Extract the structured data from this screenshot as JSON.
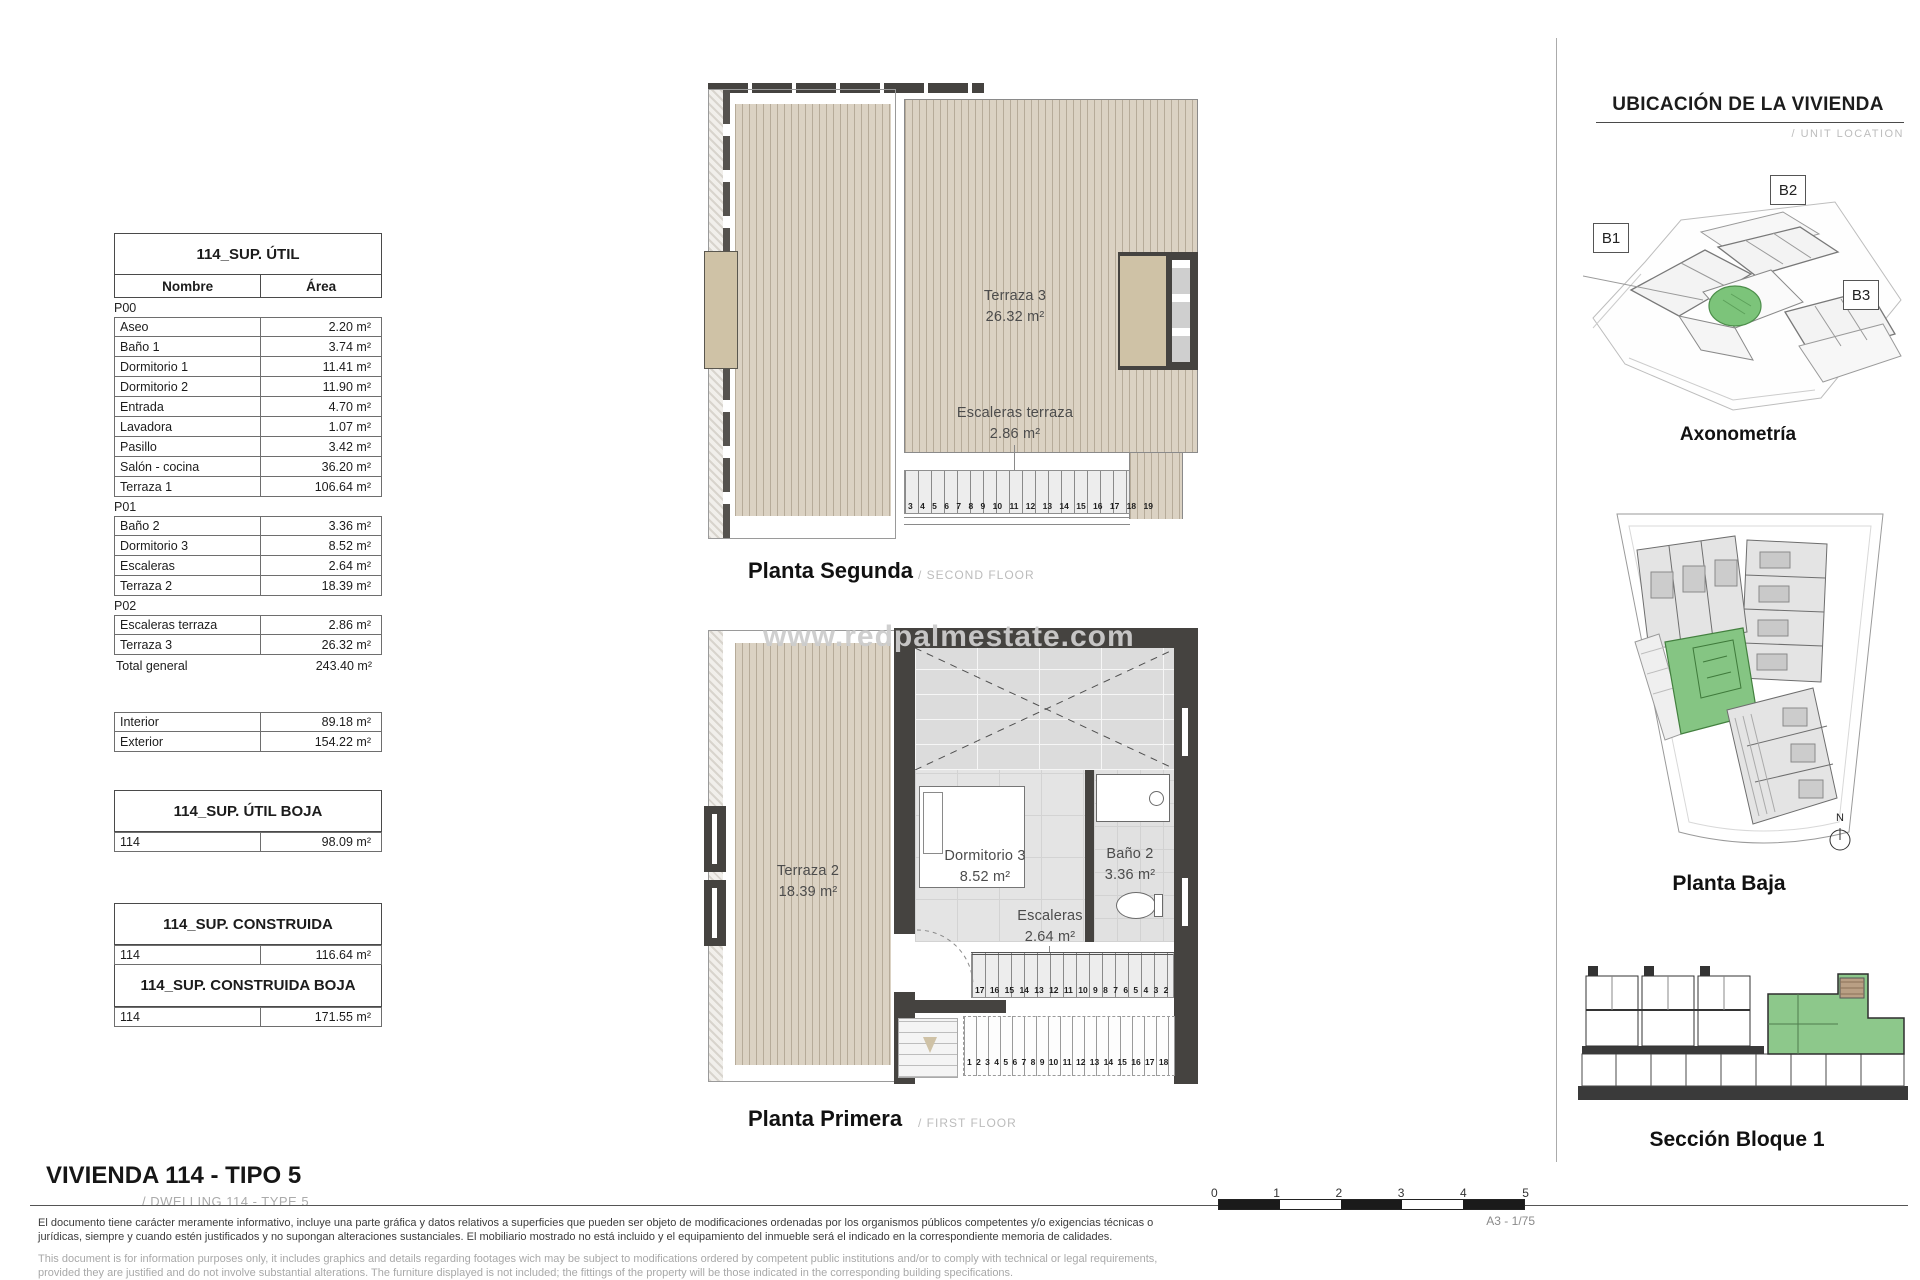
{
  "tables": {
    "sup_util": {
      "title": "114_SUP. ÚTIL",
      "col_nombre": "Nombre",
      "col_area": "Área",
      "groups": [
        {
          "name": "P00",
          "rows": [
            [
              "Aseo",
              "2.20 m²"
            ],
            [
              "Baño 1",
              "3.74 m²"
            ],
            [
              "Dormitorio 1",
              "11.41 m²"
            ],
            [
              "Dormitorio 2",
              "11.90 m²"
            ],
            [
              "Entrada",
              "4.70 m²"
            ],
            [
              "Lavadora",
              "1.07 m²"
            ],
            [
              "Pasillo",
              "3.42 m²"
            ],
            [
              "Salón - cocina",
              "36.20 m²"
            ],
            [
              "Terraza 1",
              "106.64 m²"
            ]
          ]
        },
        {
          "name": "P01",
          "rows": [
            [
              "Baño 2",
              "3.36 m²"
            ],
            [
              "Dormitorio 3",
              "8.52 m²"
            ],
            [
              "Escaleras",
              "2.64 m²"
            ],
            [
              "Terraza 2",
              "18.39 m²"
            ]
          ]
        },
        {
          "name": "P02",
          "rows": [
            [
              "Escaleras terraza",
              "2.86 m²"
            ],
            [
              "Terraza 3",
              "26.32 m²"
            ]
          ]
        }
      ],
      "total_label": "Total general",
      "total_value": "243.40 m²"
    },
    "int_ext": {
      "rows": [
        [
          "Interior",
          "89.18 m²"
        ],
        [
          "Exterior",
          "154.22 m²"
        ]
      ]
    },
    "util_boja": {
      "title": "114_SUP. ÚTIL BOJA",
      "row": [
        "114",
        "98.09 m²"
      ]
    },
    "construida": {
      "title": "114_SUP. CONSTRUIDA",
      "row": [
        "114",
        "116.64 m²"
      ]
    },
    "construida_boja": {
      "title": "114_SUP. CONSTRUIDA BOJA",
      "row": [
        "114",
        "171.55 m²"
      ]
    }
  },
  "plans": {
    "segunda": {
      "caption": "Planta Segunda",
      "caption_en": "/ SECOND FLOOR",
      "terraza3_name": "Terraza 3",
      "terraza3_area": "26.32 m²",
      "escaleras_name": "Escaleras terraza",
      "escaleras_area": "2.86 m²",
      "stair_numbers": "3 4 5 6 7 8 9 10 11 12 13 14 15 16 17 18 19"
    },
    "primera": {
      "caption": "Planta Primera",
      "caption_en": "/ FIRST FLOOR",
      "watermark": "www.redpalmestate.com",
      "terraza2_name": "Terraza 2",
      "terraza2_area": "18.39 m²",
      "dormitorio3_name": "Dormitorio 3",
      "dormitorio3_area": "8.52 m²",
      "bano2_name": "Baño 2",
      "bano2_area": "3.36 m²",
      "escaleras_name": "Escaleras",
      "escaleras_area": "2.64 m²",
      "stair_numbers_upper": "17 16 15 14 13 12 11 10 9 8 7 6 5 4 3 2",
      "stair_numbers_lower": "1 2 3 4 5 6 7 8 9 10 11 12 13 14 15 16 17 18"
    }
  },
  "sidebar": {
    "title": "UBICACIÓN DE LA VIVIENDA",
    "subtitle": "/ UNIT LOCATION",
    "axon_caption": "Axonometría",
    "baja_caption": "Planta Baja",
    "seccion_caption": "Sección Bloque 1",
    "block_labels": [
      "B1",
      "B2",
      "B3"
    ],
    "north_label": "N"
  },
  "footer": {
    "title": "VIVIENDA 114 - TIPO 5",
    "subtitle": "/ DWELLING 114 - TYPE 5",
    "disclaimer_es": "El documento tiene carácter meramente informativo, incluye una parte gráfica y datos relativos a superficies que pueden ser objeto de modificaciones ordenadas por los organismos públicos competentes y/o exigencias técnicas o jurídicas, siempre y cuando estén justificados y no supongan alteraciones sustanciales. El mobiliario mostrado no está incluido y el equipamiento del inmueble será el indicado en la correspondiente memoria de calidades.",
    "disclaimer_en": "This document is for information purposes only, it includes graphics and details regarding footages wich may be subject to modifications ordered by competent public institutions and/or to comply with technical or legal requirements, provided they are justified and do not involve substantial alterations. The furniture displayed is not included; the fittings of the property will be those indicated in the corresponding building specifications.",
    "scale_ticks": [
      "0",
      "1",
      "2",
      "3",
      "4",
      "5"
    ],
    "sheet_scale": "A3 - 1/75"
  },
  "colors": {
    "deck": "#dbd2c3",
    "deck_stripe": "#b6ab99",
    "wall": "#454340",
    "highlight_green": "#82c280",
    "tile": "#e4e4e4",
    "panel_tan": "#cfc2a6"
  }
}
